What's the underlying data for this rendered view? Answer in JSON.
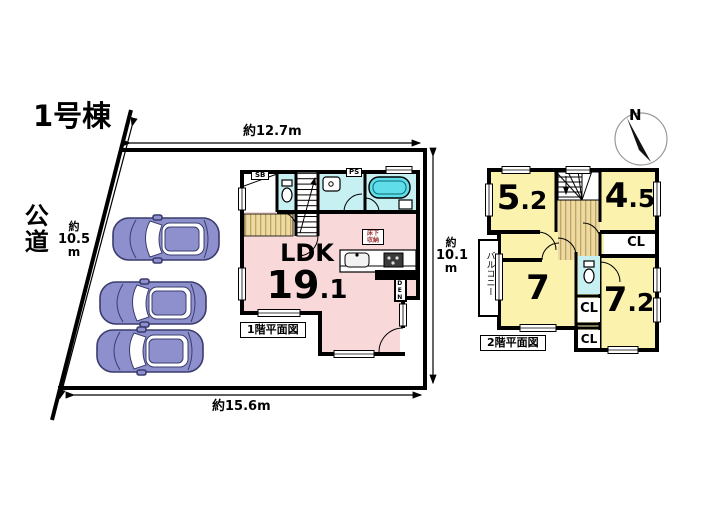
{
  "site": {
    "building_no": "1号棟",
    "road_vertical": "公道",
    "dim_top": "約12.7m",
    "dim_left_approx": "約",
    "dim_left_value": "10.5",
    "dim_left_unit": "m",
    "dim_right_approx": "約",
    "dim_right_value": "10.1",
    "dim_right_unit": "m",
    "dim_bottom": "約15.6m",
    "compass_n": "N"
  },
  "floor1": {
    "caption": "1階平面図",
    "ldk_label": "LDK",
    "ldk_area_main": "19",
    "ldk_area_frac": ".1",
    "shoe_box": "SB",
    "pipe_space": "PS",
    "floor_storage": [
      "床下",
      "収納"
    ],
    "kitchen_nook": "DEN"
  },
  "floor2": {
    "caption": "2階平面図",
    "balcony": "バルコニー",
    "rooms": [
      {
        "id": "5.2",
        "main": "5",
        "frac": ".2"
      },
      {
        "id": "4.5",
        "main": "4",
        "frac": ".5"
      },
      {
        "id": "7",
        "main": "7",
        "frac": ""
      },
      {
        "id": "7.2",
        "main": "7",
        "frac": ".2"
      }
    ],
    "closets": [
      "CL",
      "CL",
      "CL"
    ]
  },
  "colors": {
    "ldk_pink": "#f8d8d8",
    "room_yellow": "#fbf3ad",
    "wet_cyan": "#c7f0f3",
    "tub_cyan": "#5fdde9",
    "floor_tan": "#ecd9a4",
    "stripe_tan": "#bfa55e",
    "car_body": "#8d90cc",
    "car_outline": "#3a3c6e",
    "wall_black": "#000000"
  }
}
